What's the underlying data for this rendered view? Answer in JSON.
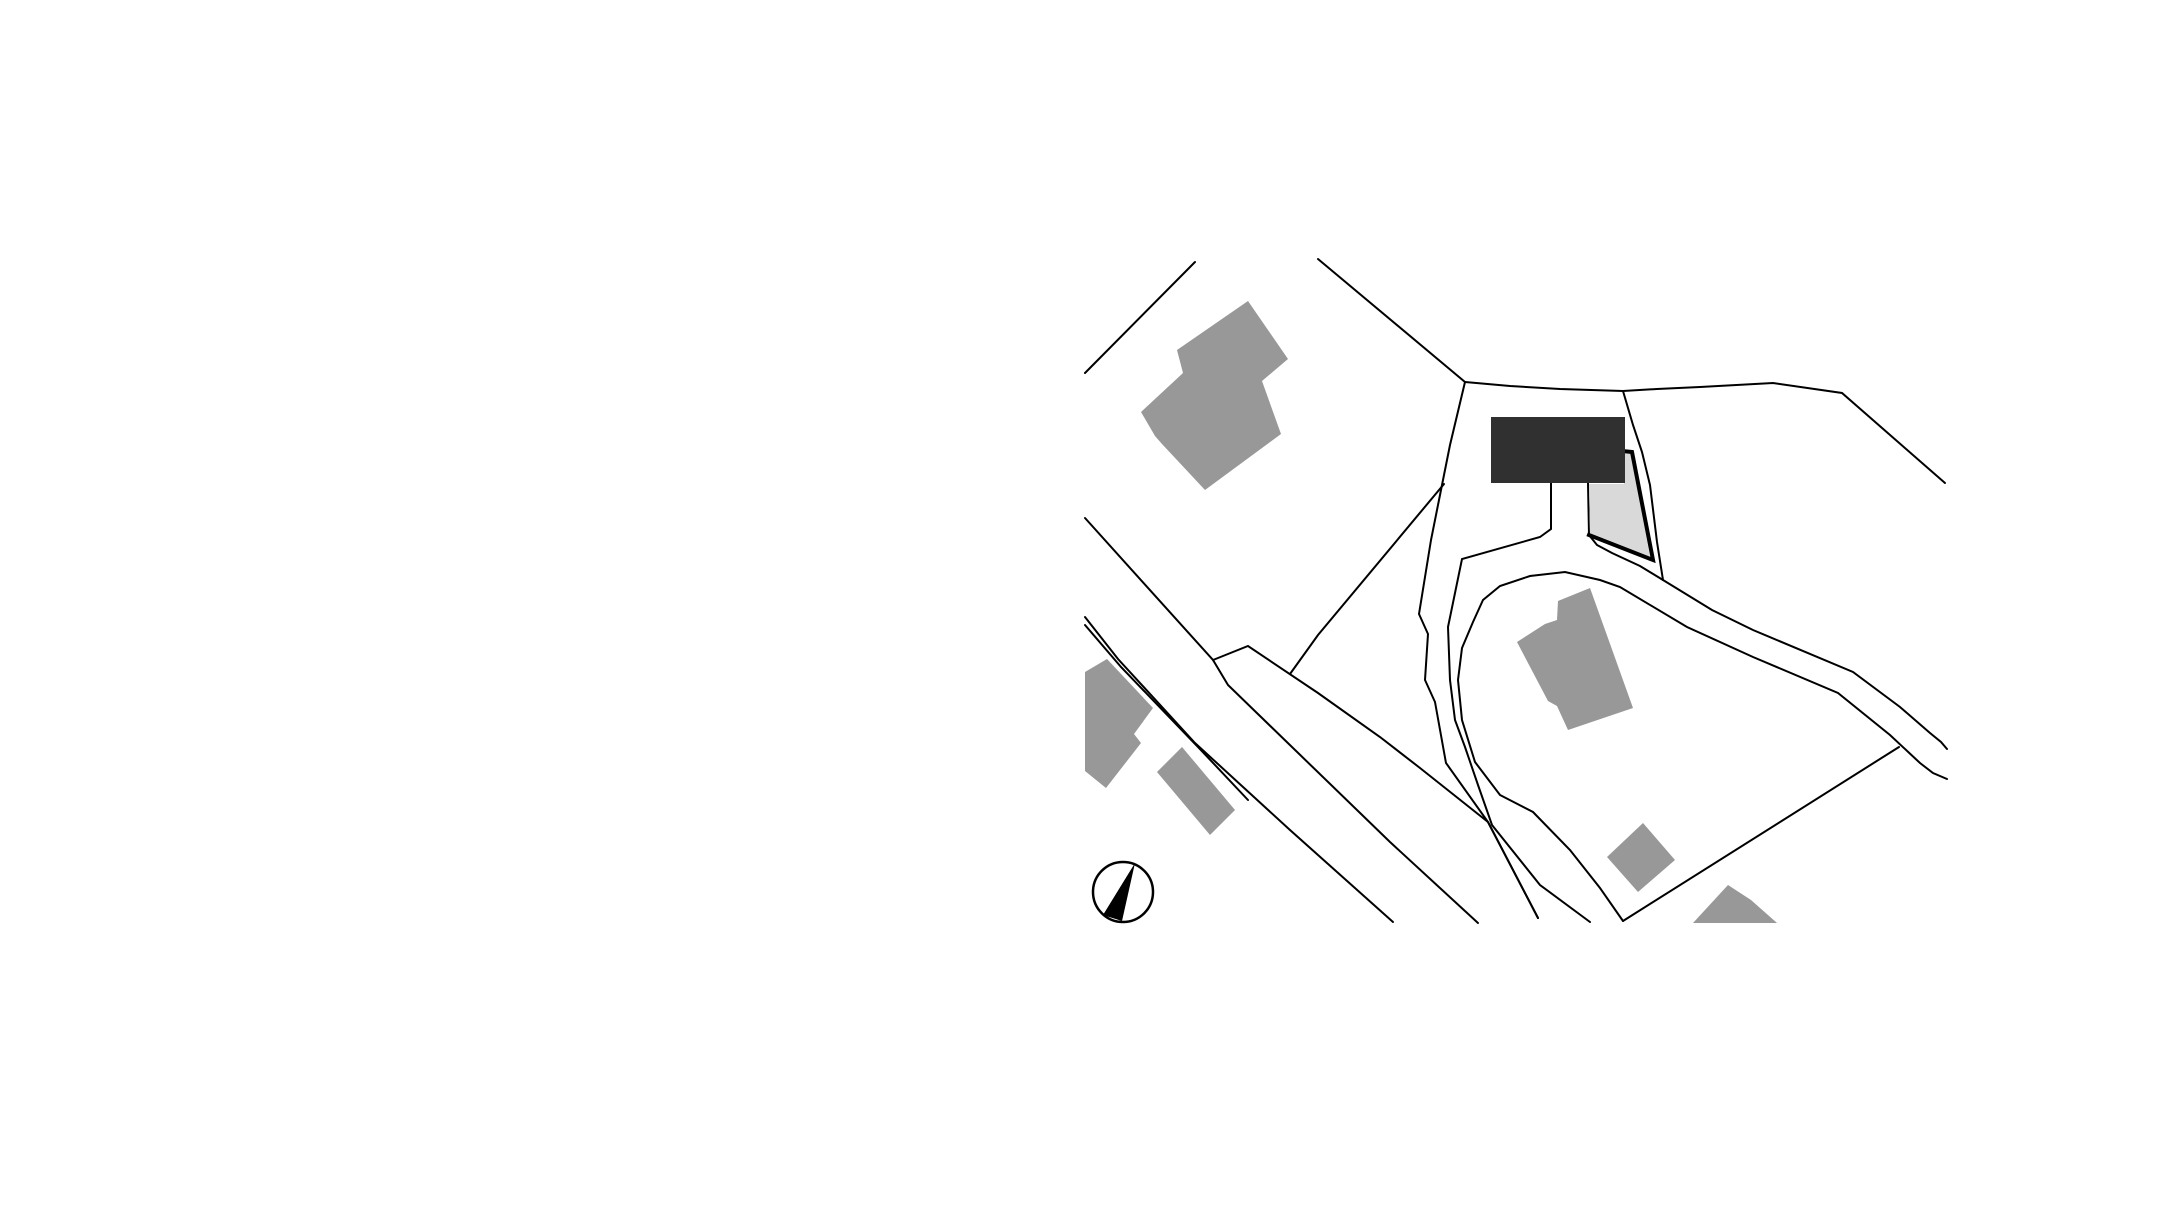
{
  "canvas": {
    "width": 2182,
    "height": 1220,
    "background": "#ffffff"
  },
  "palette": {
    "line_color": "#000000",
    "building_fill": "#989898",
    "project_building_fill": "#303030",
    "project_parcel_fill": "#d9d9d9",
    "parcel_border_color": "#000000",
    "north_arrow_color": "#000000"
  },
  "site_plan": {
    "line_width": 2,
    "boundary_lines": [
      {
        "name": "boundary-line-northwest",
        "points": [
          [
            1085,
            373
          ],
          [
            1195,
            262
          ]
        ]
      },
      {
        "name": "boundary-line-north",
        "points": [
          [
            1318,
            259
          ],
          [
            1465,
            382
          ]
        ]
      },
      {
        "name": "boundary-line-top",
        "points": [
          [
            1465,
            382
          ],
          [
            1510,
            386
          ],
          [
            1560,
            389
          ],
          [
            1623,
            391
          ],
          [
            1657,
            389
          ],
          [
            1700,
            387
          ],
          [
            1773,
            383
          ],
          [
            1842,
            393
          ],
          [
            1945,
            483
          ]
        ]
      },
      {
        "name": "parcel-boundary-west",
        "points": [
          [
            1465,
            382
          ],
          [
            1450,
            445
          ],
          [
            1440,
            495
          ],
          [
            1431,
            540
          ],
          [
            1419,
            614
          ],
          [
            1428,
            634
          ],
          [
            1425,
            680
          ],
          [
            1435,
            702
          ],
          [
            1446,
            763
          ],
          [
            1488,
            822
          ],
          [
            1538,
            918
          ]
        ]
      },
      {
        "name": "parcel-boundary-east",
        "points": [
          [
            1623,
            391
          ],
          [
            1633,
            425
          ],
          [
            1642,
            452
          ],
          [
            1650,
            485
          ],
          [
            1657,
            542
          ],
          [
            1663,
            580
          ]
        ]
      },
      {
        "name": "driveway-west-edge",
        "points": [
          [
            1551,
            483
          ],
          [
            1551,
            529
          ],
          [
            1540,
            537
          ],
          [
            1462,
            559
          ],
          [
            1448,
            627
          ],
          [
            1450,
            680
          ],
          [
            1455,
            720
          ],
          [
            1465,
            747
          ],
          [
            1478,
            785
          ],
          [
            1492,
            825
          ],
          [
            1540,
            885
          ],
          [
            1590,
            922
          ]
        ]
      },
      {
        "name": "driveway-east-edge",
        "points": [
          [
            1588,
            483
          ],
          [
            1589,
            535
          ],
          [
            1597,
            545
          ],
          [
            1612,
            553
          ],
          [
            1640,
            566
          ],
          [
            1663,
            580
          ]
        ]
      },
      {
        "name": "road-north-edge",
        "points": [
          [
            1663,
            580
          ],
          [
            1712,
            610
          ],
          [
            1753,
            630
          ],
          [
            1853,
            672
          ],
          [
            1900,
            707
          ],
          [
            1930,
            733
          ],
          [
            1941,
            742
          ],
          [
            1947,
            749
          ]
        ]
      },
      {
        "name": "road-south-edge",
        "points": [
          [
            1947,
            779
          ],
          [
            1933,
            773
          ],
          [
            1920,
            763
          ],
          [
            1890,
            735
          ],
          [
            1838,
            693
          ],
          [
            1753,
            657
          ],
          [
            1687,
            627
          ],
          [
            1620,
            587
          ],
          [
            1600,
            580
          ],
          [
            1565,
            572
          ],
          [
            1530,
            576
          ],
          [
            1500,
            586
          ],
          [
            1483,
            600
          ],
          [
            1473,
            622
          ],
          [
            1462,
            648
          ],
          [
            1458,
            680
          ],
          [
            1462,
            720
          ],
          [
            1475,
            762
          ],
          [
            1500,
            795
          ],
          [
            1533,
            812
          ],
          [
            1570,
            850
          ],
          [
            1600,
            888
          ],
          [
            1623,
            921
          ]
        ]
      },
      {
        "name": "field-boundary-southeast",
        "points": [
          [
            1623,
            921
          ],
          [
            1899,
            747
          ]
        ]
      },
      {
        "name": "road-branch-boundary",
        "points": [
          [
            1213,
            660
          ],
          [
            1248,
            646
          ],
          [
            1318,
            693
          ],
          [
            1380,
            737
          ],
          [
            1420,
            768
          ],
          [
            1488,
            822
          ],
          [
            1538,
            918
          ]
        ]
      },
      {
        "name": "spur-boundary",
        "points": [
          [
            1290,
            674
          ],
          [
            1318,
            635
          ],
          [
            1444,
            484
          ]
        ]
      },
      {
        "name": "west-road-right-edge",
        "points": [
          [
            1085,
            518
          ],
          [
            1213,
            660
          ],
          [
            1228,
            685
          ],
          [
            1390,
            842
          ],
          [
            1478,
            923
          ]
        ]
      },
      {
        "name": "west-road-left-edge-outer",
        "points": [
          [
            1085,
            617
          ],
          [
            1118,
            659
          ],
          [
            1195,
            743
          ],
          [
            1290,
            830
          ],
          [
            1393,
            922
          ]
        ]
      },
      {
        "name": "west-road-left-edge-inner",
        "points": [
          [
            1085,
            625
          ],
          [
            1121,
            667
          ],
          [
            1199,
            748
          ],
          [
            1248,
            800
          ]
        ]
      }
    ],
    "buildings": [
      {
        "name": "building-footprint-northwest",
        "points": [
          [
            1248,
            301
          ],
          [
            1288,
            359
          ],
          [
            1262,
            381
          ],
          [
            1281,
            434
          ],
          [
            1205,
            490
          ],
          [
            1162,
            444
          ],
          [
            1155,
            436
          ],
          [
            1141,
            412
          ],
          [
            1183,
            373
          ],
          [
            1177,
            350
          ]
        ]
      },
      {
        "name": "building-footprint-central",
        "points": [
          [
            1558,
            601
          ],
          [
            1590,
            588
          ],
          [
            1633,
            708
          ],
          [
            1568,
            730
          ],
          [
            1557,
            706
          ],
          [
            1548,
            701
          ],
          [
            1517,
            642
          ],
          [
            1545,
            624
          ],
          [
            1557,
            620
          ]
        ]
      },
      {
        "name": "building-footprint-southeast-small",
        "points": [
          [
            1643,
            823
          ],
          [
            1675,
            860
          ],
          [
            1638,
            892
          ],
          [
            1607,
            857
          ]
        ]
      },
      {
        "name": "building-footprint-south-clipped",
        "points": [
          [
            1693,
            923
          ],
          [
            1728,
            885
          ],
          [
            1751,
            900
          ],
          [
            1777,
            923
          ]
        ]
      },
      {
        "name": "building-footprint-west-large",
        "points": [
          [
            1085,
            672
          ],
          [
            1107,
            659
          ],
          [
            1153,
            708
          ],
          [
            1134,
            734
          ],
          [
            1141,
            743
          ],
          [
            1106,
            788
          ],
          [
            1085,
            771
          ]
        ]
      },
      {
        "name": "building-footprint-west-small",
        "points": [
          [
            1182,
            747
          ],
          [
            1235,
            810
          ],
          [
            1210,
            835
          ],
          [
            1157,
            772
          ]
        ]
      }
    ],
    "project_parcel": {
      "name": "project-parcel",
      "fill_points": [
        [
          1589,
          484
        ],
        [
          1624,
          484
        ],
        [
          1624,
          452
        ],
        [
          1631,
          452
        ],
        [
          1650,
          557
        ],
        [
          1590,
          533
        ]
      ],
      "border_points": [
        [
          1622,
          451
        ],
        [
          1632,
          452
        ],
        [
          1653,
          560
        ],
        [
          1589,
          535
        ]
      ],
      "border_width": 4
    },
    "project_building": {
      "name": "project-building",
      "x": 1491,
      "y": 417,
      "width": 134,
      "height": 66
    },
    "north_arrow": {
      "name": "north-arrow",
      "cx": 1123,
      "cy": 892,
      "r": 30,
      "ring_width": 2.5,
      "needle_points": [
        [
          1135,
          863
        ],
        [
          1103,
          915
        ],
        [
          1122,
          921
        ]
      ]
    }
  }
}
